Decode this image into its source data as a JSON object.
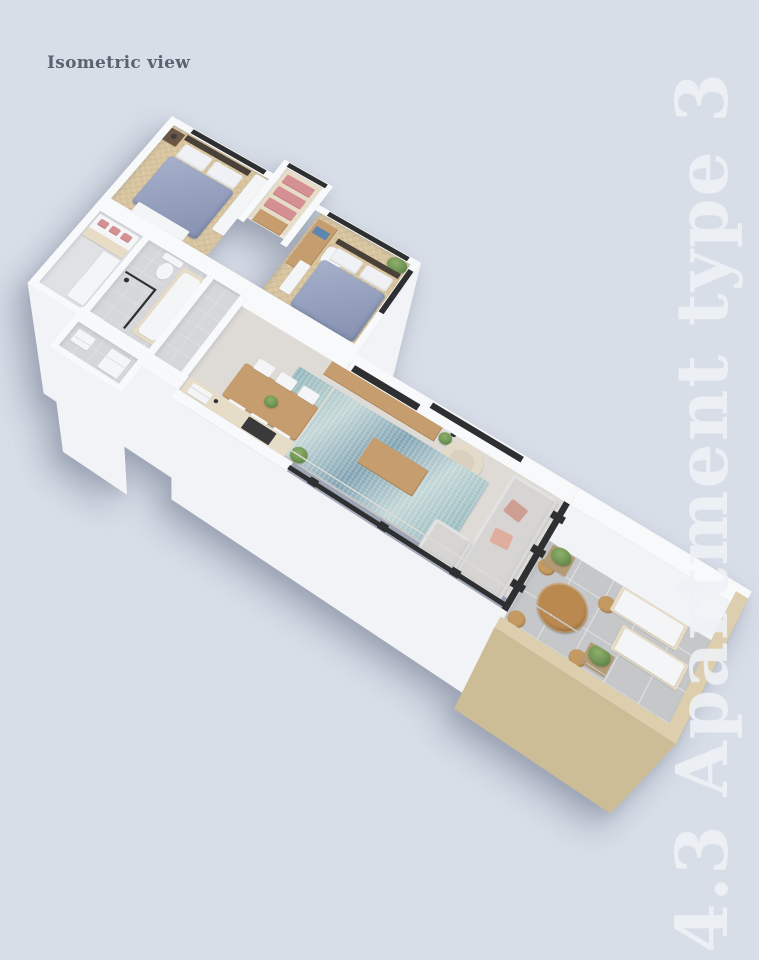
{
  "labels": {
    "view_label": "Isometric view",
    "side_title": "4.3 Apartment type 3"
  },
  "colors": {
    "bg": "#d8dee8",
    "label": "#5b6370",
    "title": "#eef1f6",
    "wall": "#f8f9fb",
    "wallFace": "#f1f3f6",
    "woodFloor": "#d8c5a0",
    "tileFloor": "#d6d7da",
    "balconyTile": "#c5c7c9",
    "livingFloor": "#dedbd6",
    "rugA": "#8fb4ba",
    "rugB": "#c3d6d6",
    "rugC": "#7fa2b2",
    "duvet": "#97a2c0",
    "pillow": "#f0f1f4",
    "headboard": "#4a4238",
    "wood": "#c59d6e",
    "brown": "#6b5646",
    "whiteFurn": "#f4f5f6",
    "tan": "#b59b74",
    "tanLight": "#e7dcc6",
    "pink": "#d59093",
    "dark": "#2e2f31",
    "cooktop": "#3a3a3d",
    "sofa": "#d6d5d3",
    "cushion": "#cf9e92",
    "armchair": "#e3dac9",
    "plant": "#6f9454",
    "plantDark": "#50713c",
    "pot": "#403e3b",
    "parapet": "#ddcfad",
    "parapetFace": "#cdbd97",
    "roundTable": "#b9894f",
    "books": "#5b86b0",
    "shadow": "rgba(105,115,135,0.42)"
  }
}
